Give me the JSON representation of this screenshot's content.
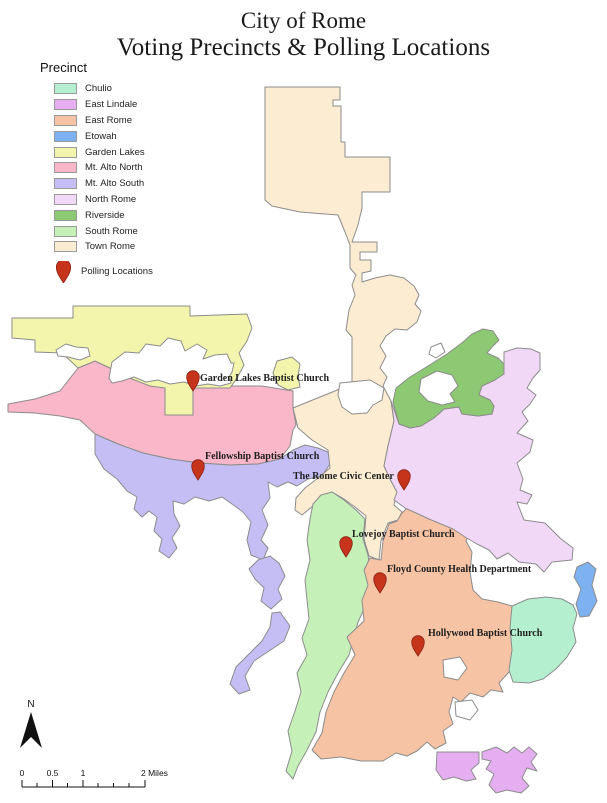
{
  "title": {
    "line1": "City of Rome",
    "line2": "Voting Precincts & Polling Locations"
  },
  "legend": {
    "title": "Precinct",
    "polling_label": "Polling Locations"
  },
  "precincts": [
    {
      "id": "chulio",
      "label": "Chulio",
      "color": "#b4f0cf"
    },
    {
      "id": "east-lindale",
      "label": "East Lindale",
      "color": "#e5aef1"
    },
    {
      "id": "east-rome",
      "label": "East Rome",
      "color": "#f6c3a4"
    },
    {
      "id": "etowah",
      "label": "Etowah",
      "color": "#7eb1f0"
    },
    {
      "id": "garden-lakes",
      "label": "Garden Lakes",
      "color": "#f3f5ad"
    },
    {
      "id": "mt-alto-north",
      "label": "Mt. Alto North",
      "color": "#f9b7c9"
    },
    {
      "id": "mt-alto-south",
      "label": "Mt. Alto South",
      "color": "#c4bef5"
    },
    {
      "id": "north-rome",
      "label": "North Rome",
      "color": "#f2d8f7"
    },
    {
      "id": "riverside",
      "label": "Riverside",
      "color": "#8dc873"
    },
    {
      "id": "south-rome",
      "label": "South Rome",
      "color": "#c5f1b8"
    },
    {
      "id": "town-rome",
      "label": "Town Rome",
      "color": "#fcecd2"
    }
  ],
  "polling_locations": [
    {
      "name": "Garden Lakes Baptist Church",
      "x": 193,
      "y": 391,
      "label_x": 200,
      "label_y": 381
    },
    {
      "name": "Fellowship Baptist Church",
      "x": 198,
      "y": 480,
      "label_x": 205,
      "label_y": 459
    },
    {
      "name": "The Rome Civic Center",
      "x": 404,
      "y": 490,
      "label_x": 293,
      "label_y": 479
    },
    {
      "name": "Lovejoy Baptist Church",
      "x": 346,
      "y": 557,
      "label_x": 352,
      "label_y": 537
    },
    {
      "name": "Floyd County Health Department",
      "x": 380,
      "y": 593,
      "label_x": 387,
      "label_y": 572
    },
    {
      "name": "Hollywood Baptist Church",
      "x": 418,
      "y": 656,
      "label_x": 428,
      "label_y": 636
    }
  ],
  "compass_label": "N",
  "scale_bar": {
    "labels": [
      "0",
      "0.5",
      "1"
    ],
    "end_label": "2 Miles"
  },
  "colors": {
    "pin": "#c5341b",
    "pin_stroke": "#8a2112",
    "boundary": "#8c8c8c"
  }
}
